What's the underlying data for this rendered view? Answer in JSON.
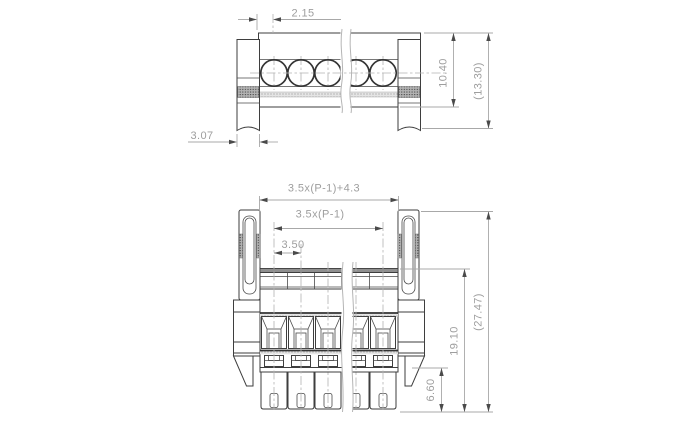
{
  "document": {
    "type": "technical-drawing",
    "subject": "pluggable-terminal-block-connector",
    "background_color": "#ffffff",
    "pole_count": 5
  },
  "colors": {
    "outline": "#3e3e3e",
    "heavy_outline": "#333333",
    "dimension_line": "#a8a8a8",
    "dimension_text": "#9e9e9e",
    "arrowhead": "#4a4a4a",
    "hatch_dots": "#555555"
  },
  "top_view": {
    "name": "top-view",
    "dims": {
      "pin_offset": "2.15",
      "flange_width": "3.07",
      "body_height": "10.40",
      "overall_height": "(13.30)"
    }
  },
  "front_view": {
    "name": "front-view",
    "dims": {
      "overall_width_formula": "3.5x(P-1)+4.3",
      "pole_span_formula": "3.5x(P-1)",
      "pitch": "3.50",
      "body_height": "19.10",
      "overall_height": "(27.47)",
      "leg_length": "6.60"
    }
  }
}
